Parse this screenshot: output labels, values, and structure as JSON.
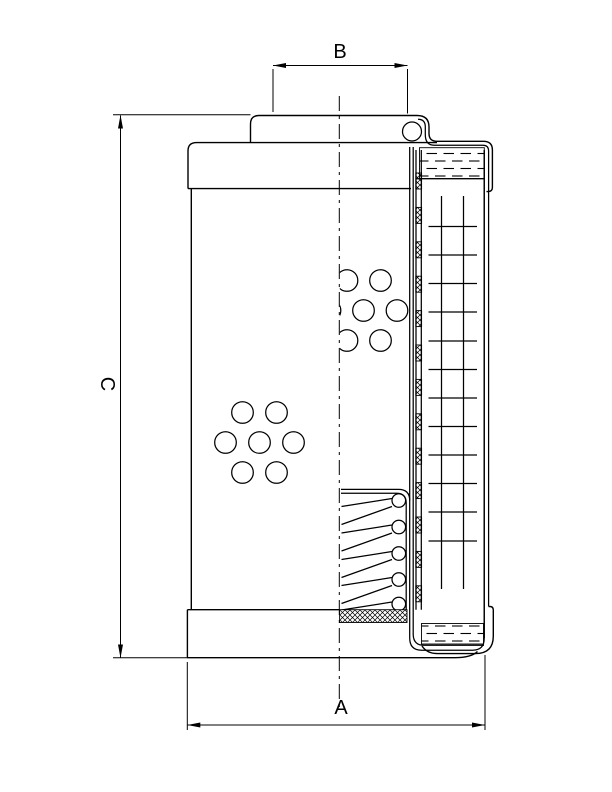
{
  "drawing": {
    "background": "#ffffff",
    "line_color": "#000000",
    "dimensions": {
      "a_label": "A",
      "b_label": "B",
      "c_label": "C"
    }
  }
}
